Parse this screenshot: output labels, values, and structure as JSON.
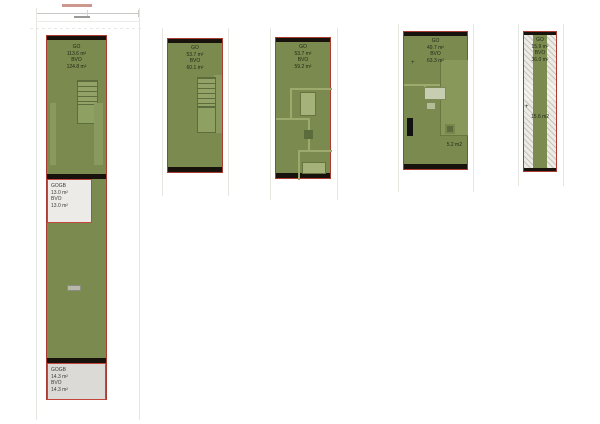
{
  "document_type": "floorplan-area-overview",
  "colors": {
    "plan_fill_green": "#7b8b50",
    "plan_border_red": "#ab3c31",
    "wall_black": "#17120b",
    "outdoor_box_grey": "#ecebe7",
    "hatch_grey": "#edebe5",
    "background": "#ffffff"
  },
  "plans": [
    {
      "name": "unit-floor-1",
      "area_label": {
        "go_label": "GO",
        "go_value": "113.6 m²",
        "bvo_label": "BVO",
        "bvo_value": "124.8 m²"
      },
      "outdoor_areas": [
        {
          "label": "GOGB",
          "value": "13.0 m²",
          "bvo_label": "BVO",
          "bvo_value": "13.0 m²"
        },
        {
          "label": "GOGB",
          "value": "14.3 m²",
          "bvo_label": "BVO",
          "bvo_value": "14.3 m²"
        }
      ]
    },
    {
      "name": "unit-floor-2",
      "area_label": {
        "go_label": "GO",
        "go_value": "53.7 m²",
        "bvo_label": "BVO",
        "bvo_value": "60.1 m²"
      }
    },
    {
      "name": "unit-floor-3",
      "area_label": {
        "go_label": "GO",
        "go_value": "53.7 m²",
        "bvo_label": "BVO",
        "bvo_value": "59.2 m²"
      }
    },
    {
      "name": "unit-floor-4",
      "area_label": {
        "go_label": "GO",
        "go_value": "49.7 m²",
        "bvo_label": "BVO",
        "bvo_value": "63.3 m²"
      },
      "room_area": "5.2 m2",
      "marker": "+"
    },
    {
      "name": "unit-floor-5",
      "area_label": {
        "go_label": "GO",
        "go_value": "15.9 m²",
        "bvo_label": "BVO",
        "bvo_value": "36.0 m²"
      },
      "room_area": "15.6 m2",
      "marker": "+"
    }
  ]
}
